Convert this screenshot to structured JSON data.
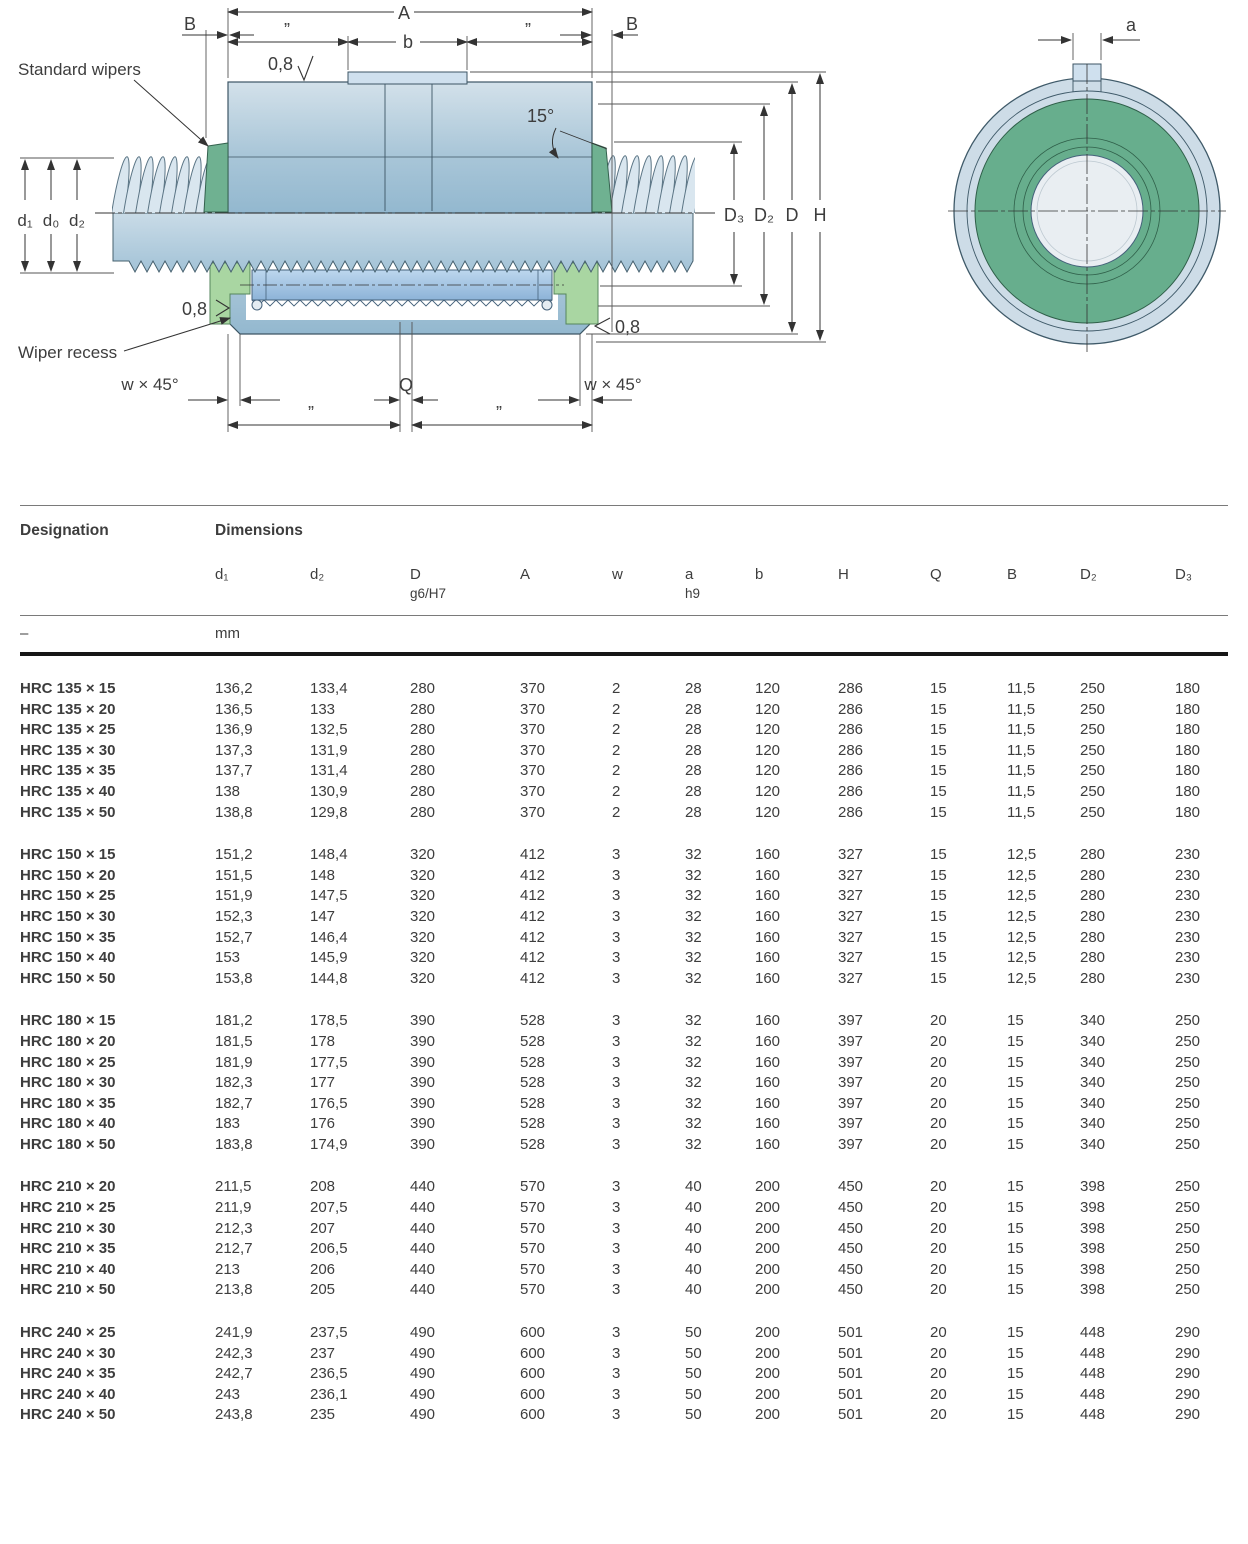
{
  "diagram": {
    "labels": {
      "standard_wipers": "Standard wipers",
      "wiper_recess": "Wiper recess",
      "dim_A": "A",
      "dim_B": "B",
      "ditto": "”",
      "dim_b": "b",
      "roughness": "0,8",
      "angle_15": "15°",
      "dim_D3": "D₃",
      "dim_D2": "D₂",
      "dim_D": "D",
      "dim_H": "H",
      "dim_w45": "w × 45°",
      "dim_Q": "Q",
      "dim_a": "a",
      "dim_d1": "d₁",
      "dim_d0": "d₀",
      "dim_d2": "d₂"
    },
    "colors": {
      "nut_blue": "#a9c6d8",
      "shaft_blue": "#c4d7e4",
      "roller_blue": "#a4c4e2",
      "wiper_green_top": "#6fb191",
      "wiper_green_bottom": "#a9d6a2",
      "end_view_green": "#67ae8d",
      "line": "#3c5564"
    }
  },
  "table": {
    "header": {
      "designation": "Designation",
      "dimensions": "Dimensions"
    },
    "columns": [
      {
        "line1": "d₁",
        "line2": ""
      },
      {
        "line1": "d₂",
        "line2": ""
      },
      {
        "line1": "D",
        "line2": "g6/H7"
      },
      {
        "line1": "A",
        "line2": ""
      },
      {
        "line1": "w",
        "line2": ""
      },
      {
        "line1": "a",
        "line2": "h9"
      },
      {
        "line1": "b",
        "line2": ""
      },
      {
        "line1": "H",
        "line2": ""
      },
      {
        "line1": "Q",
        "line2": ""
      },
      {
        "line1": "B",
        "line2": ""
      },
      {
        "line1": "D₂",
        "line2": ""
      },
      {
        "line1": "D₃",
        "line2": ""
      }
    ],
    "units_row": {
      "designation": "–",
      "unit": "mm"
    },
    "groups": [
      {
        "rows": [
          {
            "designation": "HRC 135 × 15",
            "values": [
              "136,2",
              "133,4",
              "280",
              "370",
              "2",
              "28",
              "120",
              "286",
              "15",
              "11,5",
              "250",
              "180"
            ]
          },
          {
            "designation": "HRC 135 × 20",
            "values": [
              "136,5",
              "133",
              "280",
              "370",
              "2",
              "28",
              "120",
              "286",
              "15",
              "11,5",
              "250",
              "180"
            ]
          },
          {
            "designation": "HRC 135 × 25",
            "values": [
              "136,9",
              "132,5",
              "280",
              "370",
              "2",
              "28",
              "120",
              "286",
              "15",
              "11,5",
              "250",
              "180"
            ]
          },
          {
            "designation": "HRC 135 × 30",
            "values": [
              "137,3",
              "131,9",
              "280",
              "370",
              "2",
              "28",
              "120",
              "286",
              "15",
              "11,5",
              "250",
              "180"
            ]
          },
          {
            "designation": "HRC 135 × 35",
            "values": [
              "137,7",
              "131,4",
              "280",
              "370",
              "2",
              "28",
              "120",
              "286",
              "15",
              "11,5",
              "250",
              "180"
            ]
          },
          {
            "designation": "HRC 135 × 40",
            "values": [
              "138",
              "130,9",
              "280",
              "370",
              "2",
              "28",
              "120",
              "286",
              "15",
              "11,5",
              "250",
              "180"
            ]
          },
          {
            "designation": "HRC 135 × 50",
            "values": [
              "138,8",
              "129,8",
              "280",
              "370",
              "2",
              "28",
              "120",
              "286",
              "15",
              "11,5",
              "250",
              "180"
            ]
          }
        ]
      },
      {
        "rows": [
          {
            "designation": "HRC 150 × 15",
            "values": [
              "151,2",
              "148,4",
              "320",
              "412",
              "3",
              "32",
              "160",
              "327",
              "15",
              "12,5",
              "280",
              "230"
            ]
          },
          {
            "designation": "HRC 150 × 20",
            "values": [
              "151,5",
              "148",
              "320",
              "412",
              "3",
              "32",
              "160",
              "327",
              "15",
              "12,5",
              "280",
              "230"
            ]
          },
          {
            "designation": "HRC 150 × 25",
            "values": [
              "151,9",
              "147,5",
              "320",
              "412",
              "3",
              "32",
              "160",
              "327",
              "15",
              "12,5",
              "280",
              "230"
            ]
          },
          {
            "designation": "HRC 150 × 30",
            "values": [
              "152,3",
              "147",
              "320",
              "412",
              "3",
              "32",
              "160",
              "327",
              "15",
              "12,5",
              "280",
              "230"
            ]
          },
          {
            "designation": "HRC 150 × 35",
            "values": [
              "152,7",
              "146,4",
              "320",
              "412",
              "3",
              "32",
              "160",
              "327",
              "15",
              "12,5",
              "280",
              "230"
            ]
          },
          {
            "designation": "HRC 150 × 40",
            "values": [
              "153",
              "145,9",
              "320",
              "412",
              "3",
              "32",
              "160",
              "327",
              "15",
              "12,5",
              "280",
              "230"
            ]
          },
          {
            "designation": "HRC 150 × 50",
            "values": [
              "153,8",
              "144,8",
              "320",
              "412",
              "3",
              "32",
              "160",
              "327",
              "15",
              "12,5",
              "280",
              "230"
            ]
          }
        ]
      },
      {
        "rows": [
          {
            "designation": "HRC 180 × 15",
            "values": [
              "181,2",
              "178,5",
              "390",
              "528",
              "3",
              "32",
              "160",
              "397",
              "20",
              "15",
              "340",
              "250"
            ]
          },
          {
            "designation": "HRC 180 × 20",
            "values": [
              "181,5",
              "178",
              "390",
              "528",
              "3",
              "32",
              "160",
              "397",
              "20",
              "15",
              "340",
              "250"
            ]
          },
          {
            "designation": "HRC 180 × 25",
            "values": [
              "181,9",
              "177,5",
              "390",
              "528",
              "3",
              "32",
              "160",
              "397",
              "20",
              "15",
              "340",
              "250"
            ]
          },
          {
            "designation": "HRC 180 × 30",
            "values": [
              "182,3",
              "177",
              "390",
              "528",
              "3",
              "32",
              "160",
              "397",
              "20",
              "15",
              "340",
              "250"
            ]
          },
          {
            "designation": "HRC 180 × 35",
            "values": [
              "182,7",
              "176,5",
              "390",
              "528",
              "3",
              "32",
              "160",
              "397",
              "20",
              "15",
              "340",
              "250"
            ]
          },
          {
            "designation": "HRC 180 × 40",
            "values": [
              "183",
              "176",
              "390",
              "528",
              "3",
              "32",
              "160",
              "397",
              "20",
              "15",
              "340",
              "250"
            ]
          },
          {
            "designation": "HRC 180 × 50",
            "values": [
              "183,8",
              "174,9",
              "390",
              "528",
              "3",
              "32",
              "160",
              "397",
              "20",
              "15",
              "340",
              "250"
            ]
          }
        ]
      },
      {
        "rows": [
          {
            "designation": "HRC 210 × 20",
            "values": [
              "211,5",
              "208",
              "440",
              "570",
              "3",
              "40",
              "200",
              "450",
              "20",
              "15",
              "398",
              "250"
            ]
          },
          {
            "designation": "HRC 210 × 25",
            "values": [
              "211,9",
              "207,5",
              "440",
              "570",
              "3",
              "40",
              "200",
              "450",
              "20",
              "15",
              "398",
              "250"
            ]
          },
          {
            "designation": "HRC 210 × 30",
            "values": [
              "212,3",
              "207",
              "440",
              "570",
              "3",
              "40",
              "200",
              "450",
              "20",
              "15",
              "398",
              "250"
            ]
          },
          {
            "designation": "HRC 210 × 35",
            "values": [
              "212,7",
              "206,5",
              "440",
              "570",
              "3",
              "40",
              "200",
              "450",
              "20",
              "15",
              "398",
              "250"
            ]
          },
          {
            "designation": "HRC 210 × 40",
            "values": [
              "213",
              "206",
              "440",
              "570",
              "3",
              "40",
              "200",
              "450",
              "20",
              "15",
              "398",
              "250"
            ]
          },
          {
            "designation": "HRC 210 × 50",
            "values": [
              "213,8",
              "205",
              "440",
              "570",
              "3",
              "40",
              "200",
              "450",
              "20",
              "15",
              "398",
              "250"
            ]
          }
        ]
      },
      {
        "rows": [
          {
            "designation": "HRC 240 × 25",
            "values": [
              "241,9",
              "237,5",
              "490",
              "600",
              "3",
              "50",
              "200",
              "501",
              "20",
              "15",
              "448",
              "290"
            ]
          },
          {
            "designation": "HRC 240 × 30",
            "values": [
              "242,3",
              "237",
              "490",
              "600",
              "3",
              "50",
              "200",
              "501",
              "20",
              "15",
              "448",
              "290"
            ]
          },
          {
            "designation": "HRC 240 × 35",
            "values": [
              "242,7",
              "236,5",
              "490",
              "600",
              "3",
              "50",
              "200",
              "501",
              "20",
              "15",
              "448",
              "290"
            ]
          },
          {
            "designation": "HRC 240 × 40",
            "values": [
              "243",
              "236,1",
              "490",
              "600",
              "3",
              "50",
              "200",
              "501",
              "20",
              "15",
              "448",
              "290"
            ]
          },
          {
            "designation": "HRC 240 × 50",
            "values": [
              "243,8",
              "235",
              "490",
              "600",
              "3",
              "50",
              "200",
              "501",
              "20",
              "15",
              "448",
              "290"
            ]
          }
        ]
      }
    ]
  }
}
